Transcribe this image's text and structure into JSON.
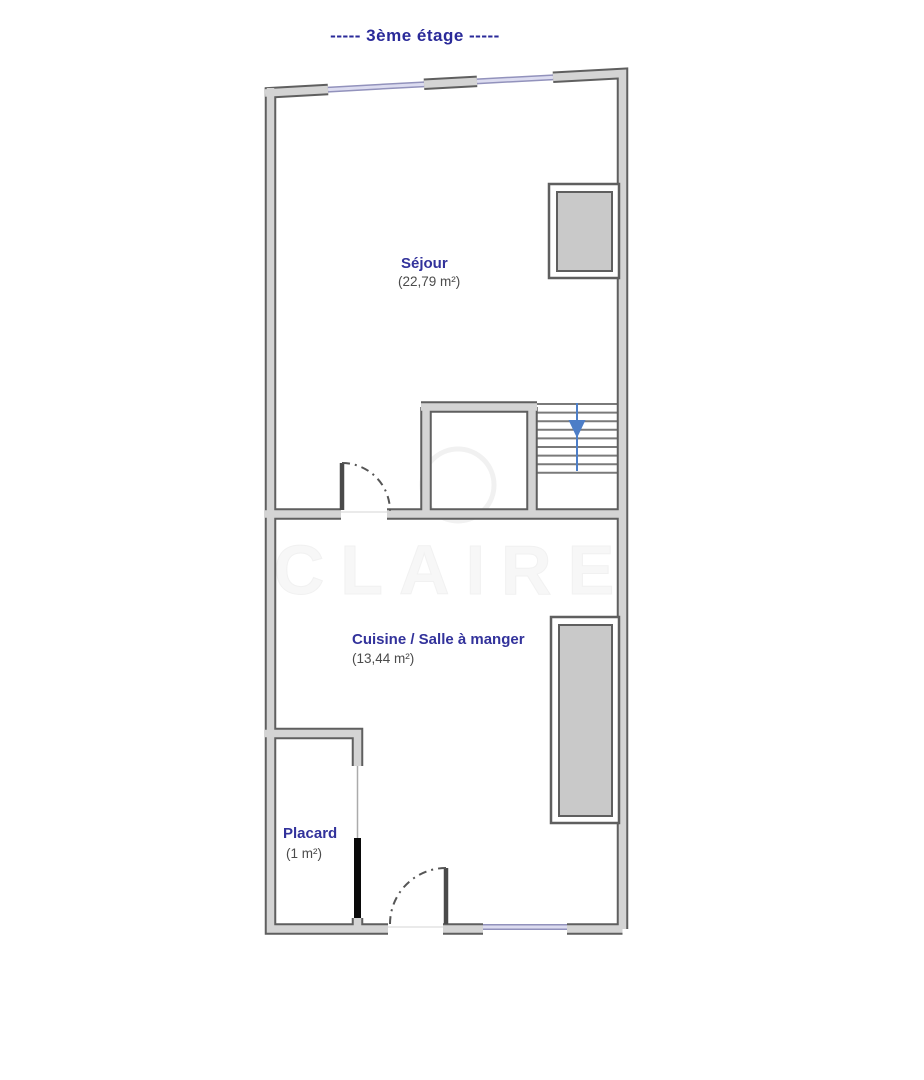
{
  "title": "-----  3ème étage  -----",
  "floor_plan": {
    "rooms": [
      {
        "name": "Séjour",
        "area": "(22,79 m²)"
      },
      {
        "name": "Cuisine / Salle à manger",
        "area": "(13,44 m²)"
      },
      {
        "name": "Placard",
        "area": "(1 m²)"
      }
    ],
    "stairs_direction": "down",
    "watermark": "CLAIRE"
  },
  "colors": {
    "title_text": "#2a2a99",
    "room_label": "#32329b",
    "area_label": "#4b4b4b",
    "wall_fill": "#d4d4d4",
    "wall_outline": "#5f5f5f",
    "window_frame": "#9292bc",
    "window_glass": "#dcdcf0",
    "stair_arrow": "#4d7ec7",
    "duct_fill": "#c9c9c9",
    "door_leaf": "#4a4a4a",
    "placard_door": "#0a0a0a",
    "watermark": "#f6f6f6"
  }
}
